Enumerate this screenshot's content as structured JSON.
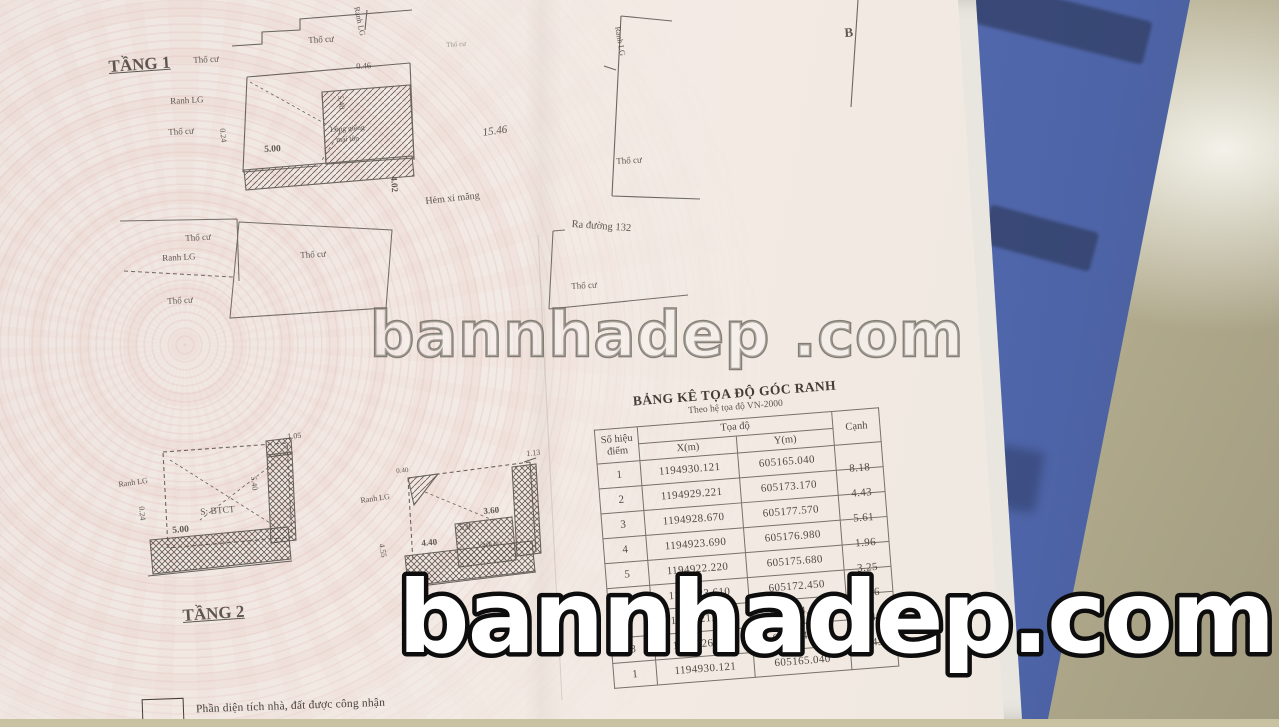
{
  "document": {
    "floor1_title": "TẦNG 1",
    "floor2_title": "TẦNG 2",
    "legend_text": "Phần diện tích nhà, đất được công nhận"
  },
  "watermark": {
    "main": "bannhadep.com",
    "mid": "bannhadep .com"
  },
  "table": {
    "title": "BẢNG KÊ TỌA ĐỘ GÓC RANH",
    "subtitle": "Theo hệ tọa độ VN-2000",
    "col_point_line1": "Số hiệu",
    "col_point_line2": "điểm",
    "col_coord_group": "Tọa độ",
    "col_x": "X(m)",
    "col_y": "Y(m)",
    "col_side": "Cạnh",
    "rows": [
      {
        "point": "1",
        "x": "1194930.121",
        "y": "605165.040",
        "canh": "8.18"
      },
      {
        "point": "2",
        "x": "1194929.221",
        "y": "605173.170",
        "canh": "4.43"
      },
      {
        "point": "3",
        "x": "1194928.670",
        "y": "605177.570",
        "canh": "5.61"
      },
      {
        "point": "4",
        "x": "1194923.690",
        "y": "605176.980",
        "canh": "1.96"
      },
      {
        "point": "5",
        "x": "1194922.220",
        "y": "605175.680",
        "canh": "3.25"
      },
      {
        "point": "6",
        "x": "1194923.610",
        "y": "605172.450",
        "canh": "8.56"
      },
      {
        "point": "7",
        "x": "1194921.500",
        "y": "605164.650",
        "canh": "4.40"
      },
      {
        "point": "8",
        "x": "1194926.730",
        "y": "605164.190",
        "canh": "2.43"
      },
      {
        "point": "1",
        "x": "1194930.121",
        "y": "605165.040",
        "canh": ""
      }
    ]
  },
  "plan_labels": [
    {
      "t": "TẦNG 1",
      "x": 108,
      "y": 58,
      "s": 17,
      "r": -4,
      "b": 1,
      "u": 1
    },
    {
      "t": "Thổ cư",
      "x": 308,
      "y": 36,
      "s": 9,
      "r": -3
    },
    {
      "t": "Ranh LG",
      "x": 360,
      "y": 6,
      "s": 8,
      "r": 78
    },
    {
      "t": "Thổ cư",
      "x": 193,
      "y": 56,
      "s": 9,
      "r": -3
    },
    {
      "t": "Ranh LG",
      "x": 170,
      "y": 97,
      "s": 9,
      "r": -3
    },
    {
      "t": "Thổ cư",
      "x": 168,
      "y": 128,
      "s": 9,
      "r": -3
    },
    {
      "t": "Thổ cư",
      "x": 446,
      "y": 42,
      "s": 7,
      "r": -3,
      "cls": "faint"
    },
    {
      "t": "0.46",
      "x": 356,
      "y": 62,
      "s": 8.5,
      "r": -3
    },
    {
      "t": "5.00",
      "x": 264,
      "y": 146,
      "s": 9.5,
      "r": -3,
      "b": 1
    },
    {
      "t": "5.40",
      "x": 344,
      "y": 95,
      "s": 8,
      "r": 84
    },
    {
      "t": "0.24",
      "x": 226,
      "y": 128,
      "s": 8,
      "r": 84
    },
    {
      "t": "Lồng giếng",
      "x": 330,
      "y": 126,
      "s": 7.5,
      "r": -4
    },
    {
      "t": "mái tôn",
      "x": 336,
      "y": 136,
      "s": 7.5,
      "r": -4
    },
    {
      "t": "4.02",
      "x": 398,
      "y": 176,
      "s": 9,
      "r": 86,
      "b": 1
    },
    {
      "t": "15.46",
      "x": 482,
      "y": 128,
      "s": 11,
      "r": -8,
      "i": 1
    },
    {
      "t": "Hẻm xi măng",
      "x": 425,
      "y": 197,
      "s": 10,
      "r": -6
    },
    {
      "t": "Ra đường 132",
      "x": 572,
      "y": 219,
      "s": 10.5,
      "r": 4
    },
    {
      "t": "Ranh LG",
      "x": 621,
      "y": 26,
      "s": 8,
      "r": 80
    },
    {
      "t": "Thổ cư",
      "x": 616,
      "y": 157,
      "s": 9,
      "r": -3
    },
    {
      "t": "B",
      "x": 844,
      "y": 26,
      "s": 13,
      "r": -4,
      "b": 1
    },
    {
      "t": "Thổ cư",
      "x": 185,
      "y": 234,
      "s": 9,
      "r": -3
    },
    {
      "t": "Ranh LG",
      "x": 162,
      "y": 254,
      "s": 9,
      "r": -3
    },
    {
      "t": "Thổ cư",
      "x": 167,
      "y": 297,
      "s": 9,
      "r": -3
    },
    {
      "t": "Thổ cư",
      "x": 300,
      "y": 251,
      "s": 9,
      "r": -3
    },
    {
      "t": "Thổ cư",
      "x": 571,
      "y": 282,
      "s": 9,
      "r": -3
    },
    {
      "t": "TẦNG 2",
      "x": 182,
      "y": 607,
      "s": 17,
      "r": -4,
      "b": 1,
      "u": 1
    },
    {
      "t": "1.05",
      "x": 287,
      "y": 433,
      "s": 8,
      "r": -5
    },
    {
      "t": "Ranh LG",
      "x": 118,
      "y": 481,
      "s": 8,
      "r": -8
    },
    {
      "t": "0.24",
      "x": 145,
      "y": 506,
      "s": 8,
      "r": 84
    },
    {
      "t": "5.00",
      "x": 172,
      "y": 527,
      "s": 9.5,
      "r": -5,
      "b": 1
    },
    {
      "t": "S: BTCT",
      "x": 200,
      "y": 509,
      "s": 9.5,
      "r": -5
    },
    {
      "t": "5.40",
      "x": 257,
      "y": 476,
      "s": 8,
      "r": 84
    },
    {
      "t": "1.13",
      "x": 526,
      "y": 450,
      "s": 8,
      "r": -5
    },
    {
      "t": "Ranh LG",
      "x": 360,
      "y": 497,
      "s": 8,
      "r": -8
    },
    {
      "t": "0.40",
      "x": 396,
      "y": 468,
      "s": 7,
      "r": -5
    },
    {
      "t": "3.60",
      "x": 483,
      "y": 507,
      "s": 9,
      "r": -5,
      "b": 1
    },
    {
      "t": "5.8",
      "x": 459,
      "y": 523,
      "s": 9,
      "r": -5
    },
    {
      "t": "4.40",
      "x": 421,
      "y": 539,
      "s": 9,
      "r": -5,
      "b": 1
    },
    {
      "t": "Vách lá",
      "x": 477,
      "y": 542,
      "s": 7,
      "r": -5
    },
    {
      "t": "4.55",
      "x": 385,
      "y": 543,
      "s": 8,
      "r": 80
    }
  ],
  "colors": {
    "paper": "#f2eae4",
    "guilloche_pink": "#ddb0aa",
    "ink": "#4a443c",
    "folder_blue": "#5a6fb2",
    "folder_strip": "#2c3a5e",
    "floor_beige": "#cdc6a6",
    "watermark_fill": "#ffffff",
    "watermark_outline": "#0d0d0d"
  }
}
